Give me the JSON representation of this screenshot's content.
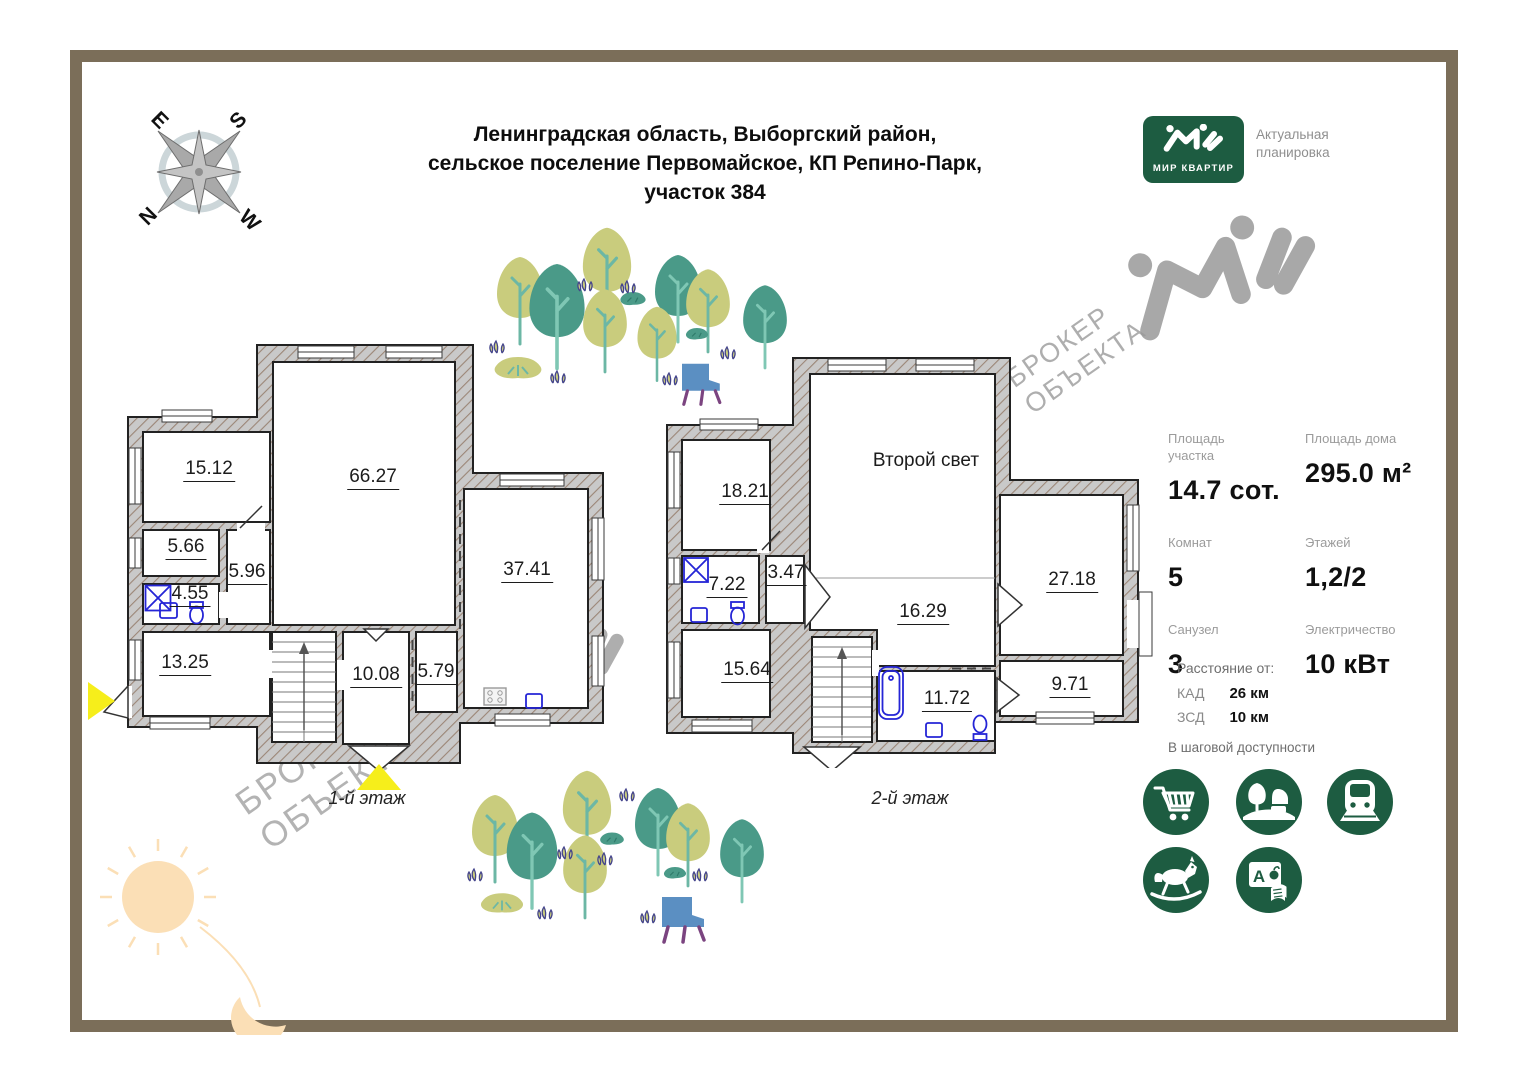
{
  "compass": {
    "letters": [
      "E",
      "S",
      "N",
      "W"
    ]
  },
  "title": {
    "lines": [
      "Ленинградская область, Выборгский район,",
      "сельское поселение Первомайское, КП Репино-Парк,",
      "участок 384"
    ]
  },
  "logo": {
    "brand": "МИР КВАРТИР",
    "caption": "Актуальная\nпланировка"
  },
  "watermark": {
    "text": "БРОКЕР\nОБЪЕКТА"
  },
  "floors": [
    {
      "label": "1-й этаж",
      "rooms": [
        {
          "area": "15.12"
        },
        {
          "area": "66.27"
        },
        {
          "area": "5.66"
        },
        {
          "area": "5.96"
        },
        {
          "area": "4.55"
        },
        {
          "area": "13.25"
        },
        {
          "area": "10.08"
        },
        {
          "area": "5.79"
        },
        {
          "area": "37.41"
        }
      ]
    },
    {
      "label": "2-й этаж",
      "note": "Второй свет",
      "rooms": [
        {
          "area": "18.21"
        },
        {
          "area": "7.22"
        },
        {
          "area": "3.47"
        },
        {
          "area": "15.64"
        },
        {
          "area": "16.29"
        },
        {
          "area": "11.72"
        },
        {
          "area": "27.18"
        },
        {
          "area": "9.71"
        }
      ]
    }
  ],
  "stats": {
    "items": [
      {
        "label": "Площадь участка",
        "value": "14.7 сот."
      },
      {
        "label": "Площадь дома",
        "value": "295.0 м²"
      },
      {
        "label": "Комнат",
        "value": "5"
      },
      {
        "label": "Этажей",
        "value": "1,2/2"
      },
      {
        "label": "Санузел",
        "value": "3"
      },
      {
        "label": "Электричество",
        "value": "10 кВт"
      }
    ]
  },
  "distances": {
    "title": "Расстояние от:",
    "items": [
      {
        "label": "КАД",
        "value": "26 км"
      },
      {
        "label": "ЗСД",
        "value": "10 км"
      }
    ]
  },
  "amenities": {
    "title": "В шаговой доступности",
    "school_letter": "А",
    "icons": [
      "shopping-cart",
      "park",
      "train",
      "rocking-horse",
      "school"
    ]
  },
  "colors": {
    "brand_green": "#1d5c41",
    "frame_brown": "#7b6e59",
    "marker_yellow": "#f6ee1b",
    "tree_olive": "#c9cc7d",
    "tree_teal": "#4a9a88",
    "fixture_blue": "#2525d6",
    "watermark_gray": "#9a9a9a"
  }
}
